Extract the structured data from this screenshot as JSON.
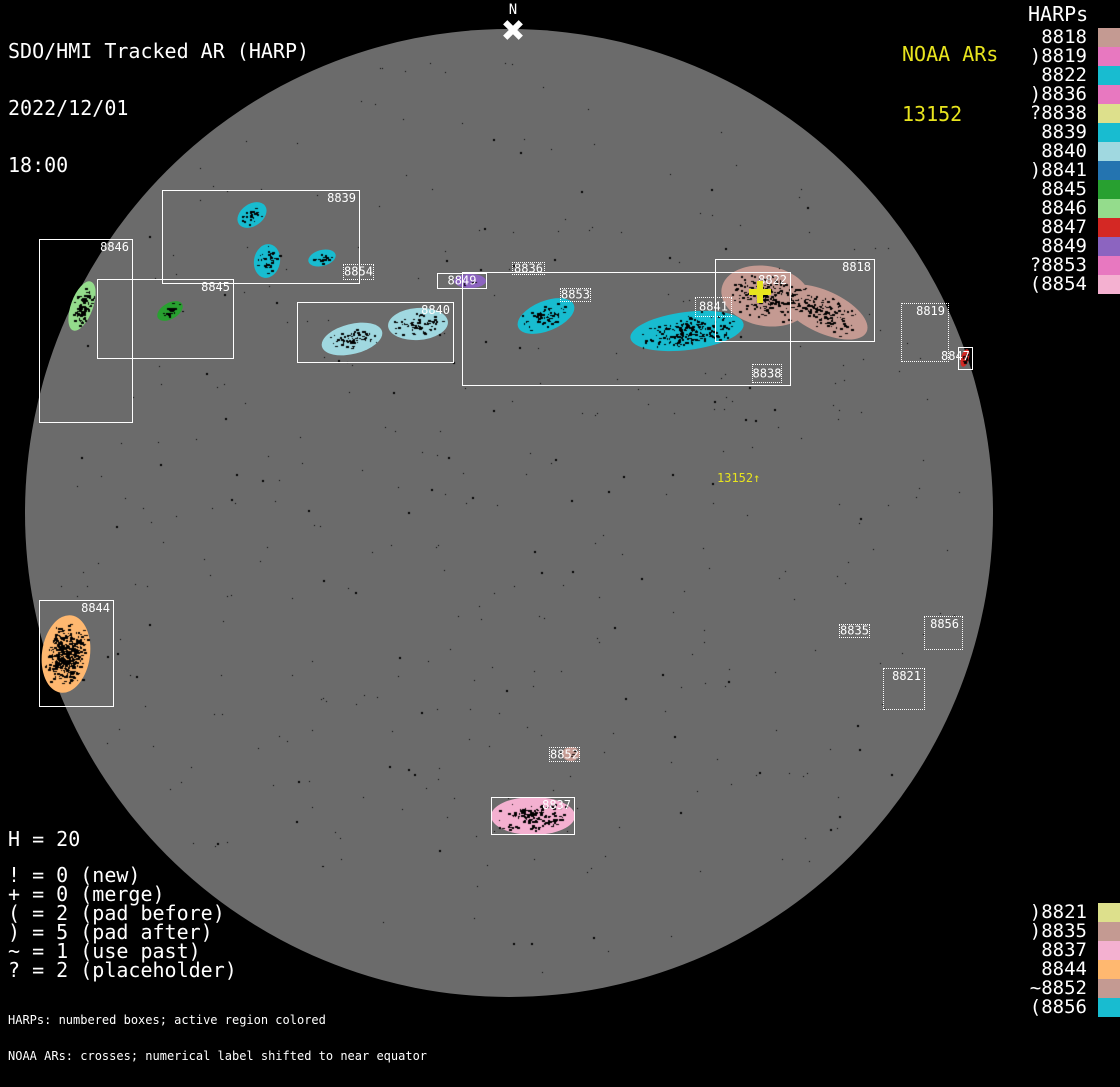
{
  "title": {
    "lines": [
      "SDO/HMI Tracked AR (HARP)",
      "2022/12/01",
      "18:00"
    ]
  },
  "north": {
    "label": "N"
  },
  "noaa": {
    "heading": "NOAA ARs",
    "number": "13152",
    "cross": {
      "x": 760,
      "y": 292
    },
    "shifted_label": {
      "text": "13152↑",
      "x": 717,
      "y": 471
    }
  },
  "harps_panel": {
    "heading": "HARPs",
    "items": [
      {
        "text": " 8818",
        "color": "#c49a92"
      },
      {
        "text": ")8819",
        "color": "#e878c0"
      },
      {
        "text": " 8822",
        "color": "#18bcd0"
      },
      {
        "text": ")8836",
        "color": "#e878c0"
      },
      {
        "text": "?8838",
        "color": "#dde08c"
      },
      {
        "text": " 8839",
        "color": "#18bcd0"
      },
      {
        "text": " 8840",
        "color": "#a0d8e0"
      },
      {
        "text": ")8841",
        "color": "#2474b0"
      },
      {
        "text": " 8845",
        "color": "#28a030"
      },
      {
        "text": " 8846",
        "color": "#94dc8c"
      },
      {
        "text": " 8847",
        "color": "#d42824"
      },
      {
        "text": " 8849",
        "color": "#8c64c0"
      },
      {
        "text": "?8853",
        "color": "#e878c0"
      },
      {
        "text": "(8854",
        "color": "#f4b0d0"
      }
    ]
  },
  "bottom_panel": {
    "items": [
      {
        "text": ")8821",
        "color": "#dde08c"
      },
      {
        "text": ")8835",
        "color": "#c49a92"
      },
      {
        "text": " 8837",
        "color": "#f4b0d0"
      },
      {
        "text": " 8844",
        "color": "#ffb870"
      },
      {
        "text": "~8852",
        "color": "#c49a92"
      },
      {
        "text": "(8856",
        "color": "#18bcd0"
      }
    ]
  },
  "stats": {
    "h_line": "H = 20",
    "rows": [
      "! = 0 (new)",
      "+ = 0 (merge)",
      "( = 2 (pad before)",
      ") = 5 (pad after)",
      "~ = 1 (use past)",
      "? = 2 (placeholder)"
    ]
  },
  "footnotes": [
    "HARPs: numbered boxes; active region colored",
    "NOAA ARs: crosses; numerical label shifted to near equator"
  ],
  "disk": {
    "cx": 509,
    "cy": 513,
    "r": 484,
    "color": "#6b6b6b"
  },
  "regions": [
    {
      "harp": "8846",
      "x": 39,
      "y": 239,
      "w": 94,
      "h": 184,
      "border": "solid",
      "label": "tr",
      "blobs": [
        {
          "cx": 82,
          "cy": 306,
          "rx": 11,
          "ry": 26,
          "rot": 20,
          "color": "#94dc8c",
          "spots": 2
        }
      ]
    },
    {
      "harp": "8839",
      "x": 162,
      "y": 190,
      "w": 198,
      "h": 94,
      "border": "solid",
      "label": "tr",
      "blobs": [
        {
          "cx": 252,
          "cy": 215,
          "rx": 16,
          "ry": 11,
          "rot": -35,
          "color": "#18bcd0",
          "spots": 1
        },
        {
          "cx": 267,
          "cy": 261,
          "rx": 13,
          "ry": 17,
          "rot": 10,
          "color": "#18bcd0",
          "spots": 1
        },
        {
          "cx": 322,
          "cy": 258,
          "rx": 14,
          "ry": 8,
          "rot": -15,
          "color": "#18bcd0",
          "spots": 1
        }
      ]
    },
    {
      "harp": "8845",
      "x": 97,
      "y": 279,
      "w": 137,
      "h": 80,
      "border": "solid",
      "label": "tr",
      "blobs": [
        {
          "cx": 170,
          "cy": 311,
          "rx": 14,
          "ry": 8,
          "rot": -30,
          "color": "#28a030",
          "spots": 1.2
        }
      ]
    },
    {
      "harp": "8854",
      "x": 343,
      "y": 264,
      "w": 31,
      "h": 16,
      "border": "dotted",
      "label": "fill",
      "blobs": []
    },
    {
      "harp": "8840",
      "x": 297,
      "y": 302,
      "w": 157,
      "h": 61,
      "border": "solid",
      "label": "tr",
      "blobs": [
        {
          "cx": 352,
          "cy": 339,
          "rx": 31,
          "ry": 15,
          "rot": -14,
          "color": "#a0d8e0",
          "spots": 1
        },
        {
          "cx": 418,
          "cy": 324,
          "rx": 30,
          "ry": 16,
          "rot": -4,
          "color": "#a0d8e0",
          "spots": 1
        }
      ]
    },
    {
      "harp": "8849",
      "x": 437,
      "y": 273,
      "w": 50,
      "h": 16,
      "border": "solid",
      "label": "fill",
      "blobs": [
        {
          "cx": 470,
          "cy": 281,
          "rx": 16,
          "ry": 7,
          "rot": 0,
          "color": "#8c64c0",
          "spots": 0.4
        }
      ]
    },
    {
      "harp": "8836",
      "x": 512,
      "y": 262,
      "w": 33,
      "h": 13,
      "border": "dotted",
      "label": "fill",
      "blobs": []
    },
    {
      "harp": "8822",
      "x": 462,
      "y": 272,
      "w": 329,
      "h": 114,
      "border": "solid",
      "label": "tr",
      "blobs": [
        {
          "cx": 546,
          "cy": 316,
          "rx": 30,
          "ry": 15,
          "rot": -22,
          "color": "#18bcd0",
          "spots": 1
        },
        {
          "cx": 687,
          "cy": 331,
          "rx": 57,
          "ry": 19,
          "rot": -7,
          "color": "#18bcd0",
          "spots": 1.3
        }
      ]
    },
    {
      "harp": "8853",
      "x": 560,
      "y": 288,
      "w": 31,
      "h": 14,
      "border": "dotted",
      "label": "fill",
      "blobs": []
    },
    {
      "harp": "8841",
      "x": 695,
      "y": 297,
      "w": 37,
      "h": 20,
      "border": "dotted",
      "label": "fill",
      "blobs": []
    },
    {
      "harp": "8818",
      "x": 715,
      "y": 259,
      "w": 160,
      "h": 83,
      "border": "solid",
      "label": "tr",
      "blobs": [
        {
          "cx": 766,
          "cy": 296,
          "rx": 45,
          "ry": 30,
          "rot": 10,
          "color": "#c49a92",
          "spots": 1
        },
        {
          "cx": 824,
          "cy": 312,
          "rx": 47,
          "ry": 21,
          "rot": 25,
          "color": "#c49a92",
          "spots": 1
        }
      ]
    },
    {
      "harp": "8838",
      "x": 752,
      "y": 364,
      "w": 30,
      "h": 19,
      "border": "dotted",
      "label": "fill",
      "blobs": []
    },
    {
      "harp": "8819",
      "x": 901,
      "y": 303,
      "w": 48,
      "h": 59,
      "border": "dotted",
      "label": "tr",
      "blobs": []
    },
    {
      "harp": "8847",
      "x": 958,
      "y": 347,
      "w": 15,
      "h": 23,
      "border": "solid",
      "label": "out-left",
      "blobs": [
        {
          "cx": 965,
          "cy": 358,
          "rx": 4,
          "ry": 9,
          "rot": 15,
          "color": "#d42824",
          "spots": 1.5
        }
      ]
    },
    {
      "harp": "8844",
      "x": 39,
      "y": 600,
      "w": 75,
      "h": 107,
      "border": "solid",
      "label": "tr",
      "blobs": [
        {
          "cx": 66,
          "cy": 654,
          "rx": 24,
          "ry": 39,
          "rot": 8,
          "color": "#ffb870",
          "spots": 3
        }
      ]
    },
    {
      "harp": "8835",
      "x": 839,
      "y": 624,
      "w": 31,
      "h": 14,
      "border": "dotted",
      "label": "fill",
      "blobs": []
    },
    {
      "harp": "8856",
      "x": 924,
      "y": 616,
      "w": 39,
      "h": 34,
      "border": "dotted",
      "label": "tr",
      "blobs": []
    },
    {
      "harp": "8821",
      "x": 883,
      "y": 668,
      "w": 42,
      "h": 42,
      "border": "dotted",
      "label": "tr",
      "blobs": []
    },
    {
      "harp": "8852",
      "x": 549,
      "y": 747,
      "w": 31,
      "h": 15,
      "border": "dotted",
      "label": "fill",
      "blobs": [
        {
          "cx": 571,
          "cy": 754,
          "rx": 9,
          "ry": 7,
          "rot": 0,
          "color": "#c49a92",
          "spots": 0.5
        }
      ]
    },
    {
      "harp": "8837",
      "x": 491,
      "y": 797,
      "w": 84,
      "h": 38,
      "border": "solid",
      "label": "tr",
      "blobs": [
        {
          "cx": 533,
          "cy": 816,
          "rx": 42,
          "ry": 19,
          "rot": 0,
          "color": "#f4b0d0",
          "spots": 1.2
        }
      ]
    }
  ]
}
